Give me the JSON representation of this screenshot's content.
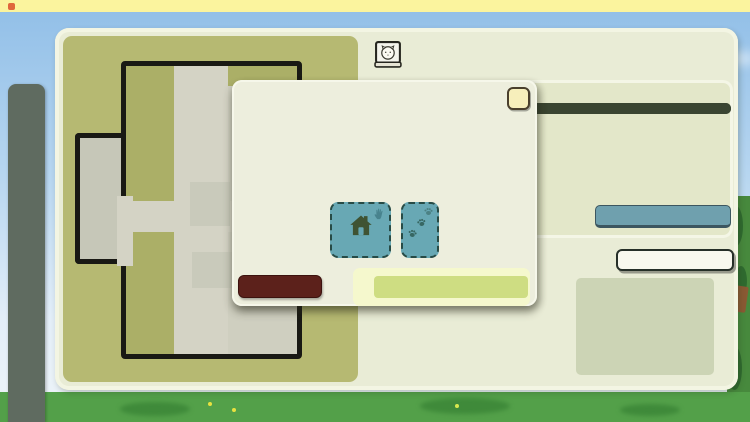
{
  "status_bar": {
    "app_title": "Shelter Management",
    "time": "03:00 PM",
    "icons": [
      "location",
      "bluetooth",
      "wifi",
      "signal",
      "battery"
    ]
  },
  "sidebar": {
    "items": [
      {
        "icon": "mail",
        "disabled": true
      },
      {
        "icon": "map",
        "disabled": false
      },
      {
        "icon": "shelter",
        "disabled": false
      },
      {
        "icon": "animals",
        "disabled": false
      },
      {
        "icon": "shop",
        "disabled": false
      },
      {
        "icon": "documents",
        "disabled": false
      },
      {
        "icon": "camera",
        "disabled": false
      },
      {
        "icon": "stats",
        "disabled": false
      },
      {
        "icon": "alerts",
        "disabled": false
      }
    ]
  },
  "floor_plan": {
    "rooms": [
      {
        "label": "Social Room",
        "icon": "cup"
      },
      {
        "label": "Storage",
        "icon": "box"
      },
      {
        "label": "Office",
        "icon": "book"
      },
      {
        "label": "Reception",
        "icon": "bell"
      },
      {
        "label": "Corridor",
        "icon": null
      },
      {
        "label": "Washing Station",
        "icon": "shower"
      },
      {
        "label": "Vet",
        "icon": "cross"
      }
    ]
  },
  "room_panel": {
    "title": "Cat cages",
    "title_icon": "cat",
    "cleanliness_label_visible": "n cleanliness",
    "cleanliness_value": 100,
    "cleanliness_percent": "100 %",
    "upgrade_level_label": "Upgrade level 1",
    "upgrade_button_label": "Upgrade room",
    "manage_workers_button_label": "Manage workers"
  },
  "modal": {
    "title": "Manage cages",
    "close_label": "x",
    "cages": {
      "total_slots": 14,
      "occupied_slots": 1
    },
    "add_cage_label": "Add cage",
    "add_door_label": "Add door",
    "revert_label": "Revert",
    "apply_label": "Apply"
  },
  "colors": {
    "accent_green": "#42c32c",
    "panel_cream": "#e9ecd6",
    "modal_cream": "#edeedd",
    "olive_dark": "#5a6440",
    "teal_button": "#68a8b4",
    "maroon_button": "#5c211b",
    "apply_button": "#cedd82",
    "status_orange": "#dd8c4c"
  }
}
